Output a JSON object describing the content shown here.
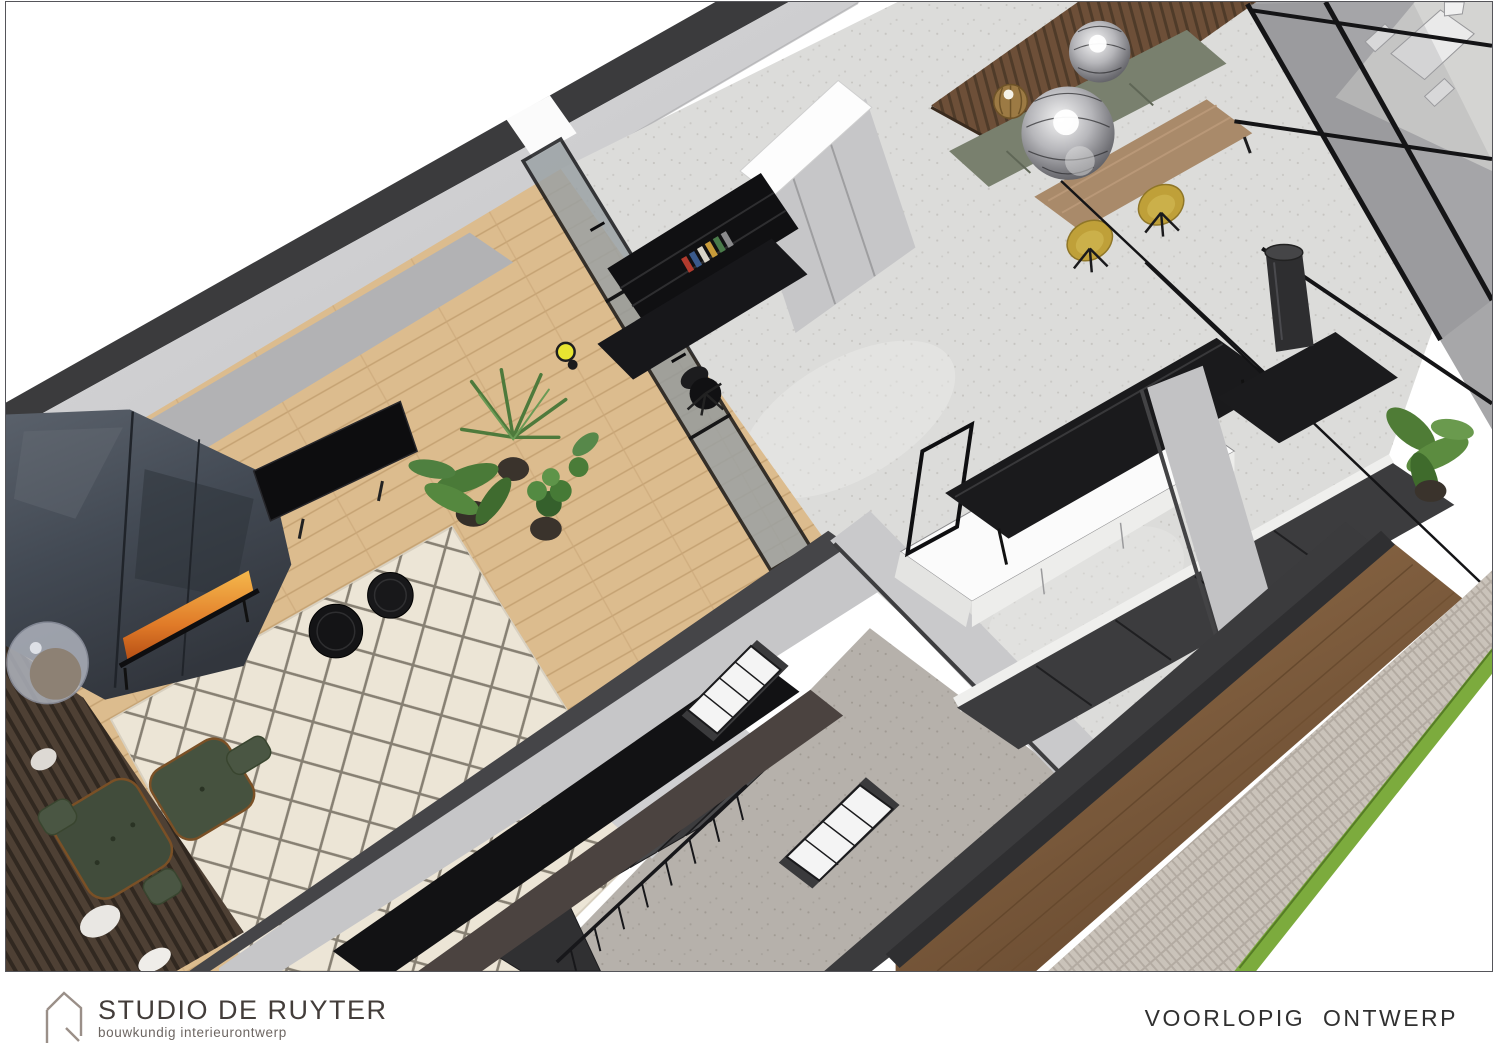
{
  "footer": {
    "brand": "STUDIO DE RUYTER",
    "tagline": "bouwkundig interieurontwerp",
    "status": "VOORLOPIG  ONTWERP"
  },
  "palette": {
    "wall-dark": "#3b3b3d",
    "wall-face": "#d4d4d6",
    "concrete": "#dcdcda",
    "speckle-floor": "#b6b1ab",
    "rug": "#ece5d6",
    "steel-dark": "#3a3f47",
    "fire": "#e08030",
    "glass": "#8f979b",
    "plant-green": "#4e7a3c",
    "lounge-green": "#44503e",
    "chair-yellow": "#bfa039",
    "bench-green": "#79806e",
    "slat-wood": "#6d4f38",
    "facade-wood": "#8a6848",
    "brick": "#b3aba2",
    "grass": "#7cab3d",
    "lamp-yellow": "#e8e431"
  },
  "scene": {
    "regions": [
      "living-room",
      "office-nook",
      "hallway-stairs",
      "kitchen",
      "dining-area",
      "garden-room",
      "exterior-path"
    ]
  }
}
